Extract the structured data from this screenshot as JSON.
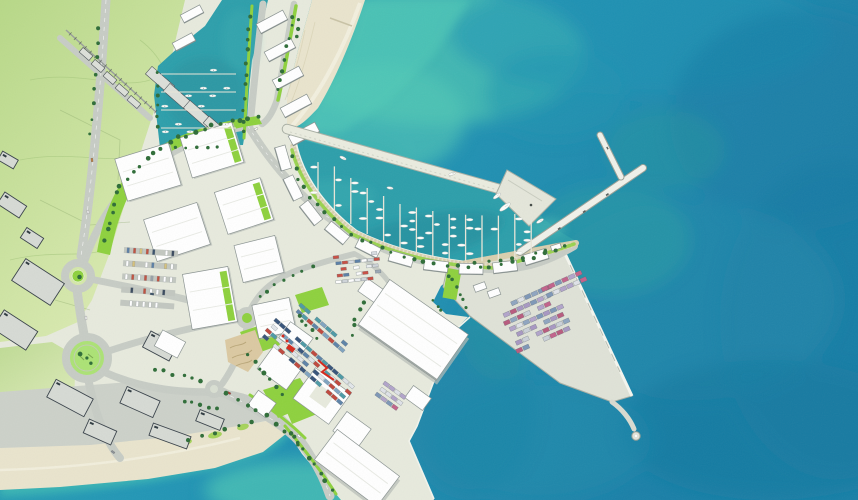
{
  "scene": {
    "type": "illustrated-aerial-master-plan",
    "subject": "coastal port, marinas, container terminal and waterfront development",
    "visible_text": ""
  },
  "palette": {
    "sea_deep": "#1b80a8",
    "sea_mid": "#2397b6",
    "sea_light": "#35aeb2",
    "shallow": "#4cc4b4",
    "foam": "#bfe9dd",
    "sand": "#e9e4cd",
    "sand_light": "#f3f0e0",
    "land_green": "#bedc8e",
    "land_green_light": "#dcebb4",
    "land_pale": "#e7eadd",
    "road": "#c7ccc5",
    "apron": "#ccd1c9",
    "building_white": "#ffffff",
    "building_stroke": "#8b9492",
    "building_shade": "#b6bcb6",
    "industrial": "#d6dad4",
    "industrial_stroke": "#39424a",
    "lime": "#8ed13e",
    "tree": "#2f6d38",
    "pier": "#dfe2d7",
    "pier_stroke": "#a9afa4",
    "breakwater": "#eaecdf",
    "marina_water": "#2d9fab",
    "marina_deep": "#1f8896",
    "promenade": "#d8cfae",
    "dune": "#dbc9a2",
    "accent_red": "#d5281b"
  },
  "generated": {
    "tree_chains": [
      {
        "pts": [
          [
            104,
            244
          ],
          [
            120,
            186
          ],
          [
            146,
            158
          ],
          [
            176,
            139
          ],
          [
            208,
            127
          ],
          [
            244,
            119
          ],
          [
            263,
            115
          ]
        ],
        "n": 24,
        "r": 2
      },
      {
        "pts": [
          [
            292,
            152
          ],
          [
            300,
            182
          ],
          [
            320,
            210
          ],
          [
            352,
            234
          ],
          [
            394,
            255
          ],
          [
            442,
            266
          ],
          [
            492,
            268
          ],
          [
            536,
            257
          ],
          [
            570,
            245
          ]
        ],
        "n": 30,
        "r": 1.8
      },
      {
        "pts": [
          [
            251,
            10
          ],
          [
            247,
            60
          ],
          [
            244,
            105
          ],
          [
            242,
            138
          ]
        ],
        "n": 11,
        "r": 1.7
      },
      {
        "pts": [
          [
            159,
            68
          ],
          [
            156,
            100
          ],
          [
            158,
            134
          ]
        ],
        "n": 6,
        "r": 1.7
      },
      {
        "pts": [
          [
            295,
            10
          ],
          [
            288,
            45
          ],
          [
            281,
            75
          ],
          [
            277,
            97
          ]
        ],
        "n": 8,
        "r": 1.7
      },
      {
        "pts": [
          [
            222,
            392
          ],
          [
            248,
            404
          ],
          [
            272,
            419
          ],
          [
            292,
            436
          ],
          [
            303,
            450
          ]
        ],
        "n": 9,
        "r": 1.9
      },
      {
        "pts": [
          [
            246,
            352
          ],
          [
            260,
            368
          ],
          [
            272,
            382
          ],
          [
            284,
            396
          ]
        ],
        "n": 7,
        "r": 1.9
      },
      {
        "pts": [
          [
            296,
            312
          ],
          [
            308,
            326
          ],
          [
            318,
            340
          ]
        ],
        "n": 5,
        "r": 1.8
      },
      {
        "pts": [
          [
            288,
            430
          ],
          [
            305,
            452
          ],
          [
            320,
            473
          ],
          [
            334,
            493
          ]
        ],
        "n": 8,
        "r": 1.9
      },
      {
        "pts": [
          [
            447,
            271
          ],
          [
            455,
            286
          ],
          [
            463,
            300
          ],
          [
            469,
            310
          ]
        ],
        "n": 6,
        "r": 1.7
      },
      {
        "pts": [
          [
            470,
            262
          ],
          [
            500,
            262
          ],
          [
            528,
            256
          ],
          [
            552,
            248
          ]
        ],
        "n": 7,
        "r": 1.6
      },
      {
        "pts": [
          [
            254,
            300
          ],
          [
            272,
            286
          ],
          [
            294,
            274
          ],
          [
            316,
            264
          ]
        ],
        "n": 7,
        "r": 1.7
      },
      {
        "pts": [
          [
            150,
            368
          ],
          [
            170,
            373
          ],
          [
            190,
            378
          ],
          [
            205,
            384
          ]
        ],
        "n": 6,
        "r": 1.8
      },
      {
        "pts": [
          [
            180,
            400
          ],
          [
            200,
            404
          ],
          [
            220,
            410
          ]
        ],
        "n": 5,
        "r": 1.8
      },
      {
        "pts": [
          [
            182,
            442
          ],
          [
            208,
            434
          ],
          [
            236,
            426
          ],
          [
            258,
            421
          ]
        ],
        "n": 6,
        "r": 1.8
      },
      {
        "pts": [
          [
            100,
            22
          ],
          [
            97,
            60
          ],
          [
            94,
            100
          ],
          [
            90,
            140
          ]
        ],
        "n": 8,
        "r": 1.6
      },
      {
        "pts": [
          [
            168,
            146
          ],
          [
            196,
            147
          ],
          [
            224,
            146
          ]
        ],
        "n": 5,
        "r": 1.7
      },
      {
        "pts": [
          [
            366,
            300
          ],
          [
            356,
            318
          ],
          [
            352,
            338
          ]
        ],
        "n": 5,
        "r": 1.7
      },
      {
        "pts": [
          [
            432,
            300
          ],
          [
            441,
            312
          ]
        ],
        "n": 3,
        "r": 1.6
      },
      {
        "pts": [
          [
            300,
            14
          ],
          [
            296,
            40
          ]
        ],
        "n": 3,
        "r": 1.7
      },
      {
        "pts": [
          [
            78,
            276
          ],
          [
            78,
            277
          ]
        ],
        "n": 1,
        "r": 2.2
      },
      {
        "pts": [
          [
            80,
            352
          ],
          [
            94,
            366
          ]
        ],
        "n": 3,
        "r": 2
      }
    ],
    "containers": [
      {
        "x": 497,
        "y": 308,
        "a": -24,
        "rows": 7,
        "cols": 8,
        "cw": 6.4,
        "ch": 4.2,
        "gx": 1,
        "gy": 3.4,
        "st": 3,
        "seed": 7,
        "colors": [
          "#c2638b",
          "#7e97b7",
          "#b2a4ca",
          "#dfe2e8",
          "#b85b7e",
          "#8fa5c0",
          "#cbd0d8",
          "#a898c2"
        ]
      },
      {
        "x": 541,
        "y": 288,
        "a": -24,
        "rows": 2,
        "cols": 6,
        "cw": 6.4,
        "ch": 4.2,
        "gx": 1,
        "gy": 3.4,
        "st": 2,
        "seed": 3,
        "colors": [
          "#c2638b",
          "#7e97b7",
          "#b2a4ca",
          "#dfe2e8"
        ]
      },
      {
        "x": 276,
        "y": 318,
        "a": 41,
        "rows": 4,
        "cols": 15,
        "cw": 6.2,
        "ch": 3.6,
        "gx": 0.8,
        "gy": 3,
        "st": 2,
        "seed": 11,
        "colors": [
          "#c0483d",
          "#5d83a8",
          "#e2e6ea",
          "#4d9aa6",
          "#37547a",
          "#c0483d",
          "#dfe3e7",
          "#7fa3c0"
        ]
      },
      {
        "x": 301,
        "y": 303,
        "a": 41,
        "rows": 2,
        "cols": 9,
        "cw": 6.2,
        "ch": 3.6,
        "gx": 0.8,
        "gy": 3,
        "st": 2,
        "seed": 5,
        "colors": [
          "#c0483d",
          "#5d83a8",
          "#e2e6ea",
          "#4d9aa6",
          "#7fa3c0"
        ]
      },
      {
        "x": 385,
        "y": 381,
        "a": 36,
        "rows": 3,
        "cols": 4,
        "cw": 6,
        "ch": 3.8,
        "gx": 0.8,
        "gy": 3,
        "st": 1,
        "seed": 9,
        "colors": [
          "#c2638b",
          "#7e97b7",
          "#dfe2e8",
          "#b2a4ca"
        ]
      },
      {
        "x": 333,
        "y": 256,
        "a": -6,
        "rows": 5,
        "cols": 7,
        "cw": 5.6,
        "ch": 3,
        "gx": 0.8,
        "gy": 3.2,
        "st": 2,
        "seed": 13,
        "colors": [
          "#ffffff",
          "#9aa7b5",
          "#c94f44",
          "#d8dde2",
          "#5b7fa6",
          "#cfd4d9",
          "#eceff1"
        ]
      }
    ],
    "parking": [
      {
        "x": 124,
        "y": 250,
        "a": 4,
        "rows": 5,
        "gap": 13.2,
        "len": 54,
        "per": 8,
        "seed": 21,
        "colors": [
          "#3a4a5e",
          "#ffffff",
          "#ffffff",
          "#c1513f",
          "#5b7fa6",
          "#9aa1a8",
          "#ffffff",
          "#39506a",
          "#d7c27b",
          "#ffffff"
        ]
      }
    ],
    "cars_free": [
      {
        "x": 92,
        "y": 160,
        "r": 83,
        "c": "#c87f3a"
      },
      {
        "x": 88,
        "y": 212,
        "r": 86,
        "c": "#ffffff"
      },
      {
        "x": 152,
        "y": 294,
        "r": 10,
        "c": "#35506b"
      },
      {
        "x": 256,
        "y": 129,
        "r": -28,
        "c": "#ffffff"
      },
      {
        "x": 229,
        "y": 393,
        "r": 28,
        "c": "#b23a2e"
      },
      {
        "x": 299,
        "y": 436,
        "r": 40,
        "c": "#ffffff"
      },
      {
        "x": 113,
        "y": 452,
        "r": 36,
        "c": "#8b9298"
      },
      {
        "x": 86,
        "y": 318,
        "r": 88,
        "c": "#ffffff"
      }
    ],
    "marina": {
      "quay": [
        [
          316,
          200
        ],
        [
          325,
          205
        ],
        [
          357,
          231
        ],
        [
          400,
          252
        ],
        [
          447,
          262
        ],
        [
          497,
          264
        ],
        [
          532,
          255
        ]
      ],
      "bw": [
        [
          295,
          138
        ],
        [
          515,
          196
        ]
      ],
      "fingers": {
        "x0": 318,
        "dx": 16.4,
        "n": 14,
        "maxLen": 46
      },
      "seed": 17
    },
    "basin": {
      "ys": [
        74,
        92,
        110,
        128
      ],
      "x1": 161,
      "x2": 236,
      "seed": 29
    },
    "boats_single": [
      {
        "x": 505,
        "y": 207,
        "r": -36,
        "l": 6.5,
        "w": 2.2
      },
      {
        "x": 497,
        "y": 196,
        "r": -36,
        "l": 4.5,
        "w": 1.7
      },
      {
        "x": 343,
        "y": 158,
        "r": 25,
        "l": 3.5,
        "w": 1.4
      },
      {
        "x": 540,
        "y": 221,
        "r": -30,
        "l": 4,
        "w": 1.5
      },
      {
        "x": 452,
        "y": 174,
        "r": -15,
        "l": 3.4,
        "w": 1.3
      },
      {
        "x": 390,
        "y": 188,
        "r": 10,
        "l": 3.2,
        "w": 1.3
      }
    ],
    "buildings": {
      "sheds": [
        {
          "x": 148,
          "y": 172,
          "w": 56,
          "h": 44,
          "r": -17,
          "g": 0
        },
        {
          "x": 212,
          "y": 150,
          "w": 54,
          "h": 42,
          "r": -17,
          "g": 1
        },
        {
          "x": 177,
          "y": 232,
          "w": 56,
          "h": 44,
          "r": -18,
          "g": 0
        },
        {
          "x": 244,
          "y": 206,
          "w": 48,
          "h": 44,
          "r": -18,
          "g": 1
        },
        {
          "x": 210,
          "y": 298,
          "w": 46,
          "h": 56,
          "r": -10,
          "g": 1
        },
        {
          "x": 259,
          "y": 259,
          "w": 42,
          "h": 38,
          "r": -14,
          "g": 0
        },
        {
          "x": 274,
          "y": 318,
          "w": 38,
          "h": 34,
          "r": -12,
          "g": 0
        }
      ],
      "arc": [
        {
          "x": 283,
          "y": 158,
          "r": 74
        },
        {
          "x": 293,
          "y": 188,
          "r": 64
        },
        {
          "x": 311,
          "y": 213,
          "r": 52
        },
        {
          "x": 337,
          "y": 233,
          "r": 40
        },
        {
          "x": 368,
          "y": 248,
          "r": 27
        },
        {
          "x": 401,
          "y": 259,
          "r": 16
        },
        {
          "x": 436,
          "y": 266,
          "r": 7
        },
        {
          "x": 471,
          "y": 269,
          "r": 1
        },
        {
          "x": 505,
          "y": 267,
          "r": -7
        },
        {
          "x": 536,
          "y": 257,
          "r": -17
        }
      ],
      "basin_rows": [
        {
          "x": 272,
          "y": 22
        },
        {
          "x": 280,
          "y": 50
        },
        {
          "x": 288,
          "y": 78
        },
        {
          "x": 296,
          "y": 106
        },
        {
          "x": 304,
          "y": 134
        },
        {
          "x": 192,
          "y": 14,
          "w": 22,
          "h": 9
        },
        {
          "x": 184,
          "y": 42,
          "w": 22,
          "h": 9
        }
      ],
      "town": [
        {
          "x": 86,
          "y": 54,
          "w": 13,
          "h": 6
        },
        {
          "x": 98,
          "y": 66,
          "w": 13,
          "h": 6
        },
        {
          "x": 110,
          "y": 78,
          "w": 13,
          "h": 6
        },
        {
          "x": 122,
          "y": 90,
          "w": 13,
          "h": 6
        },
        {
          "x": 134,
          "y": 102,
          "w": 13,
          "h": 6
        },
        {
          "x": 160,
          "y": 80,
          "w": 30,
          "h": 10
        },
        {
          "x": 178,
          "y": 97,
          "w": 30,
          "h": 10
        },
        {
          "x": 198,
          "y": 114,
          "w": 30,
          "h": 10
        },
        {
          "x": 216,
          "y": 128,
          "w": 26,
          "h": 9
        }
      ],
      "industrial": [
        {
          "x": 38,
          "y": 282,
          "r": 33,
          "w": 46,
          "h": 26
        },
        {
          "x": 15,
          "y": 330,
          "r": 33,
          "w": 40,
          "h": 22
        },
        {
          "x": 12,
          "y": 205,
          "r": 33,
          "w": 26,
          "h": 14
        },
        {
          "x": 32,
          "y": 238,
          "r": 33,
          "w": 20,
          "h": 12
        },
        {
          "x": 70,
          "y": 398,
          "r": 28,
          "w": 42,
          "h": 20
        },
        {
          "x": 140,
          "y": 402,
          "r": 24,
          "w": 36,
          "h": 18
        },
        {
          "x": 100,
          "y": 432,
          "r": 24,
          "w": 30,
          "h": 15
        },
        {
          "x": 170,
          "y": 436,
          "r": 20,
          "w": 40,
          "h": 13
        },
        {
          "x": 210,
          "y": 420,
          "r": 22,
          "w": 26,
          "h": 12
        },
        {
          "x": 8,
          "y": 160,
          "r": 30,
          "w": 18,
          "h": 10
        },
        {
          "x": 160,
          "y": 346,
          "r": 28,
          "w": 30,
          "h": 18
        }
      ],
      "plaza": [
        {
          "x": 280,
          "y": 368,
          "r": 36,
          "w": 36,
          "h": 28
        },
        {
          "x": 296,
          "y": 338,
          "r": 36,
          "w": 28,
          "h": 20
        },
        {
          "x": 352,
          "y": 430,
          "r": 36,
          "w": 30,
          "h": 24
        },
        {
          "x": 262,
          "y": 404,
          "r": 36,
          "w": 22,
          "h": 18
        },
        {
          "x": 418,
          "y": 398,
          "r": 36,
          "w": 22,
          "h": 15
        },
        {
          "x": 556,
          "y": 247,
          "r": -18,
          "w": 10,
          "h": 5
        },
        {
          "x": 373,
          "y": 292,
          "r": 35,
          "w": 26,
          "h": 16
        },
        {
          "x": 480,
          "y": 287,
          "r": -20,
          "w": 12,
          "h": 7
        },
        {
          "x": 494,
          "y": 293,
          "r": -20,
          "w": 12,
          "h": 7
        },
        {
          "x": 170,
          "y": 344,
          "r": 28,
          "w": 26,
          "h": 18
        }
      ]
    }
  }
}
